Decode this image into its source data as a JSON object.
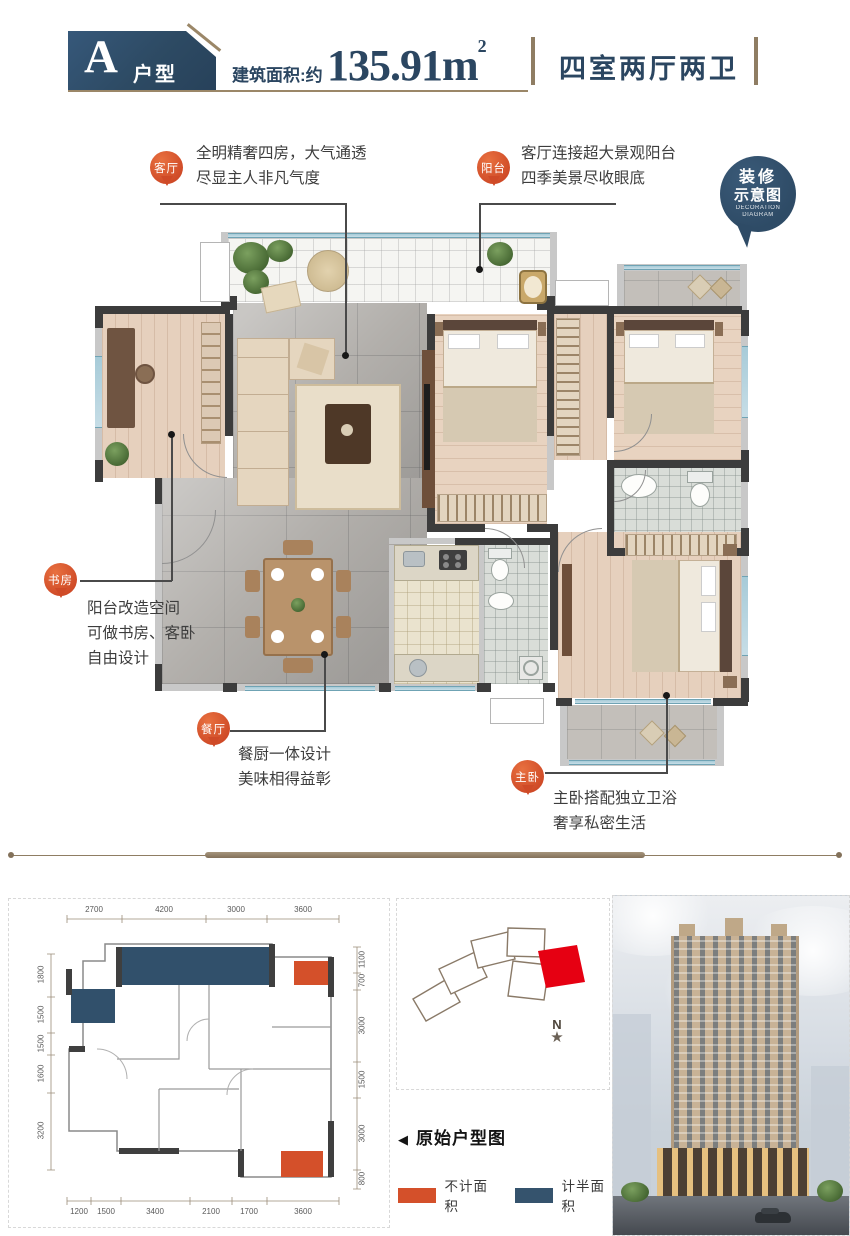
{
  "header": {
    "type_letter": "A",
    "type_label": "户型",
    "area_prefix": "建筑面积:约",
    "area_value": "135.91m",
    "area_exponent": "2",
    "layout_text": "四室两厅两卫"
  },
  "decoration_badge": {
    "line1": "装修",
    "line2": "示意图",
    "line3": "DECORATION",
    "line4": "DIAGRAM"
  },
  "callouts": {
    "living": {
      "pin": "客厅",
      "line1": "全明精奢四房，大气通透",
      "line2": "尽显主人非凡气度"
    },
    "balcony": {
      "pin": "阳台",
      "line1": "客厅连接超大景观阳台",
      "line2": "四季美景尽收眼底"
    },
    "study": {
      "pin": "书房",
      "line1": "阳台改造空间",
      "line2": "可做书房、客卧",
      "line3": "自由设计"
    },
    "dining": {
      "pin": "餐厅",
      "line1": "餐厨一体设计",
      "line2": "美味相得益彰"
    },
    "master": {
      "pin": "主卧",
      "line1": "主卧搭配独立卫浴",
      "line2": "奢享私密生活"
    }
  },
  "original_plan": {
    "dims_top": [
      "2700",
      "4200",
      "3000",
      "3600"
    ],
    "dims_bottom": [
      "1200",
      "1500",
      "3400",
      "2100",
      "1700",
      "3600"
    ],
    "dims_left": [
      "1800",
      "1500",
      "1500",
      "1600",
      "3200"
    ],
    "dims_right": [
      "1100",
      "700",
      "3000",
      "1500",
      "3000",
      "800"
    ]
  },
  "site_map": {
    "north_label": "N",
    "compass_star": "★"
  },
  "legend": {
    "arrow": "◀",
    "title": "原始户型图",
    "items": [
      {
        "label": "不计面积",
        "color": "#d4502a"
      },
      {
        "label": "计半面积",
        "color": "#35536d"
      }
    ]
  },
  "colors": {
    "header_blue": "#2d4a63",
    "accent_tan": "#9b8768",
    "pin_orange": "#cf4a27",
    "site_highlight_red": "#e60012"
  }
}
